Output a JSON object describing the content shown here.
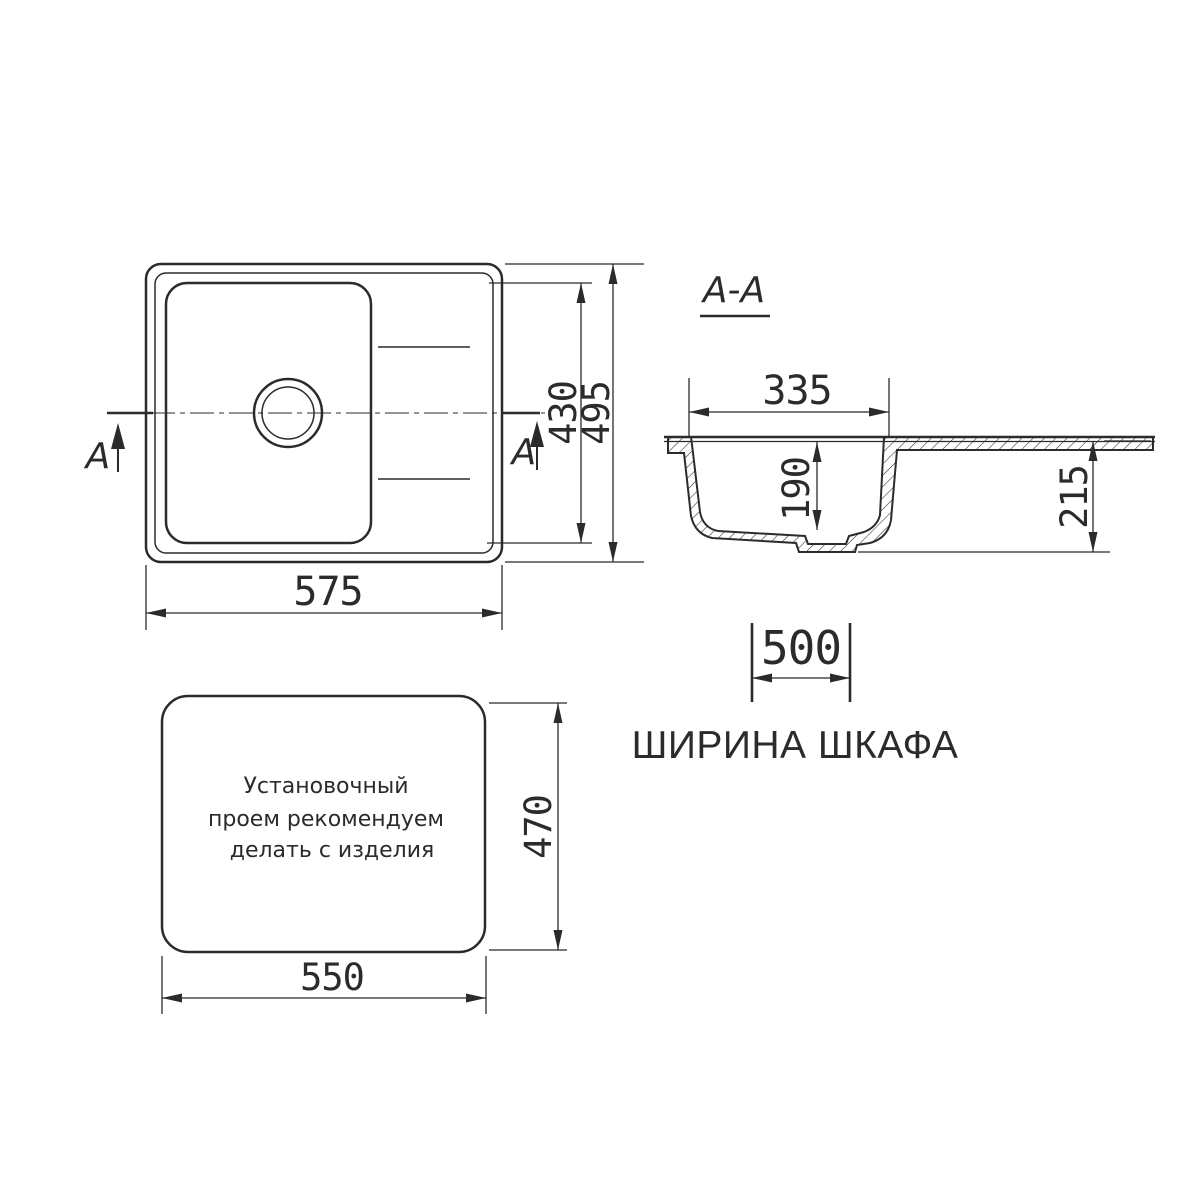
{
  "colors": {
    "line": "#2b2b2b",
    "background": "#ffffff"
  },
  "top_view": {
    "dim_width": "575",
    "dim_inner_height": "430",
    "dim_outer_height": "495",
    "marker_left": "A",
    "marker_right": "A"
  },
  "section_view": {
    "title": "A-A",
    "dim_bowl_width": "335",
    "dim_bowl_depth": "190",
    "dim_total_height": "215"
  },
  "cabinet_note": {
    "dim_width": "500",
    "caption": "ШИРИНА ШКАФА"
  },
  "cutout_view": {
    "note_lines": [
      "Установочный",
      "проем рекомендуем",
      "делать с изделия"
    ],
    "dim_width": "550",
    "dim_height": "470"
  }
}
